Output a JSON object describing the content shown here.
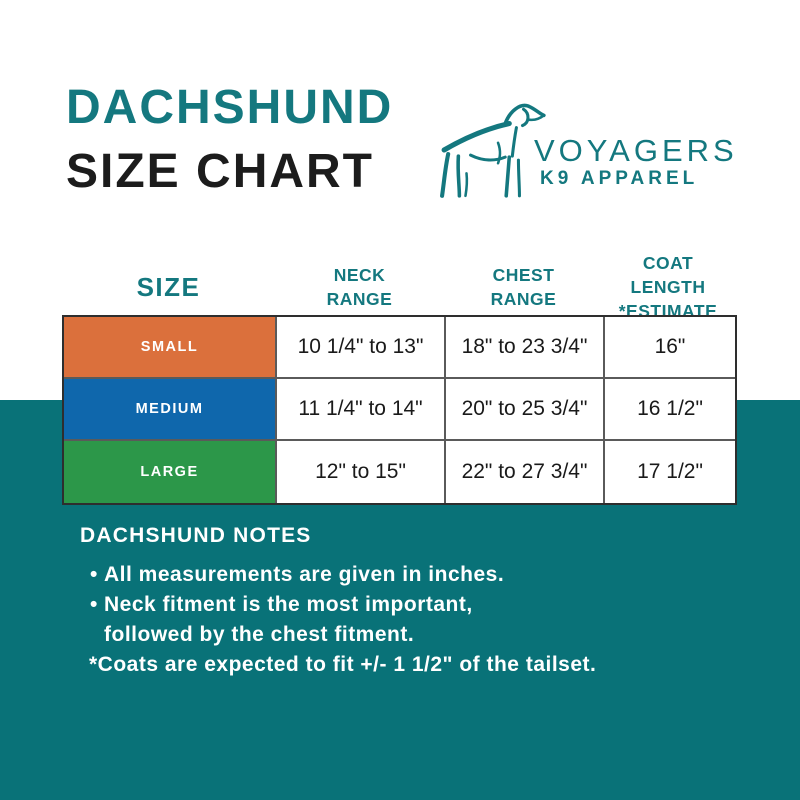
{
  "colors": {
    "teal_background": "#097278",
    "teal_accent": "#14787f",
    "orange_small": "#db703c",
    "blue_medium": "#0f67ac",
    "green_large": "#2c9749",
    "table_border": "#2e2e2e",
    "cell_text": "#1a1a1a",
    "white": "#ffffff"
  },
  "title": {
    "line1": "DACHSHUND",
    "line2": "SIZE CHART"
  },
  "logo": {
    "dog_icon": "dog-line-art",
    "brand": "VOYAGERS",
    "sub_brand": "K9 APPAREL"
  },
  "chart_data": {
    "type": "table",
    "title": "DACHSHUND SIZE CHART",
    "columns": [
      {
        "line1": "SIZE",
        "line2": ""
      },
      {
        "line1": "NECK",
        "line2": "RANGE"
      },
      {
        "line1": "CHEST",
        "line2": "RANGE"
      },
      {
        "line1": "COAT LENGTH",
        "line2": "*ESTIMATE"
      }
    ],
    "rows": [
      {
        "size": "SMALL",
        "row_color": "#db703c",
        "neck": "10 1/4\" to 13\"",
        "chest": "18\" to 23 3/4\"",
        "coat_length": "16\""
      },
      {
        "size": "MEDIUM",
        "row_color": "#0f67ac",
        "neck": "11 1/4\" to 14\"",
        "chest": "20\" to 25 3/4\"",
        "coat_length": "16 1/2\""
      },
      {
        "size": "LARGE",
        "row_color": "#2c9749",
        "neck": "12\" to 15\"",
        "chest": "22\" to 27 3/4\"",
        "coat_length": "17 1/2\""
      }
    ]
  },
  "notes": {
    "heading": "DACHSHUND NOTES",
    "bullets": [
      "All measurements are given in inches.",
      "Neck fitment is the most important,"
    ],
    "continuation": "followed by the chest fitment.",
    "footnote": "*Coats are expected to fit +/- 1 1/2\" of the tailset."
  }
}
